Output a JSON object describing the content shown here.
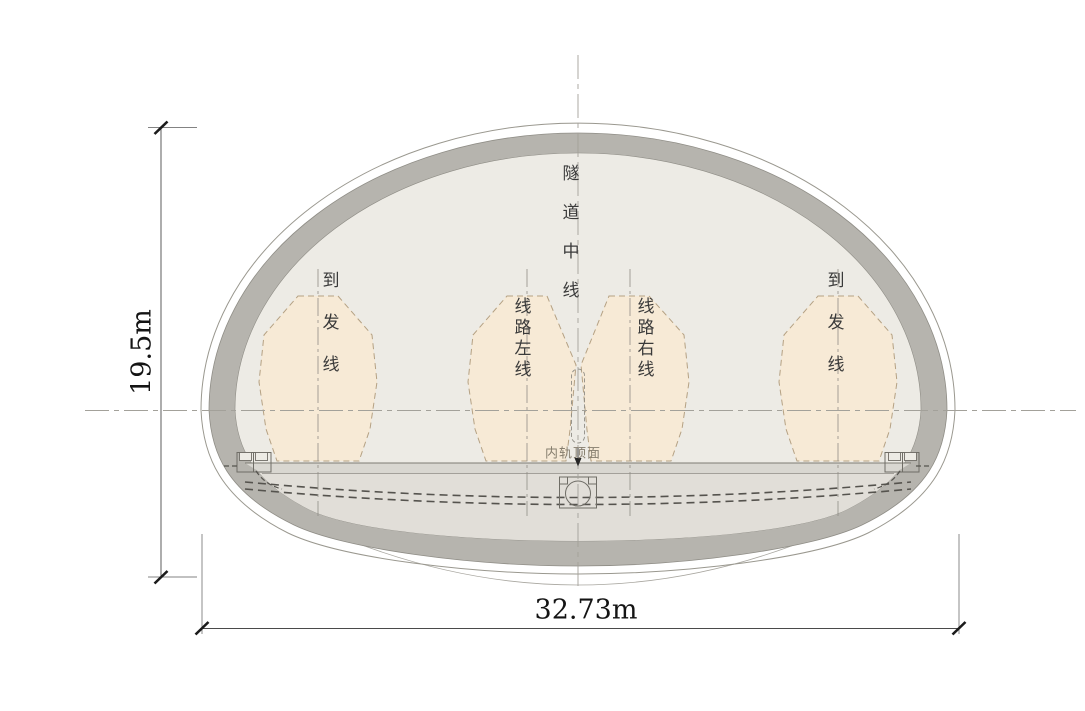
{
  "drawing": {
    "dimensions": {
      "height_label": "19.5m",
      "width_label": "32.73m"
    },
    "labels": {
      "tunnel_centerline": "隧道中线",
      "left_siding": "到发线",
      "route_left": "线路左线",
      "route_right": "线路右线",
      "right_siding": "到发线",
      "inner_rail_top": "内轨顶面"
    },
    "colors": {
      "lining": "#b6b4ae",
      "void-fill": "#edebe5",
      "invert-fill": "#e1ded8",
      "gauge-fill": "#f7ead6",
      "gauge-stroke": "#b5a183",
      "outline": "#8f8d86",
      "centerline": "#a3a19a",
      "dim": "#262626",
      "pipe": "#55534e",
      "label-ink": "#3a3a3a",
      "rail-label-ink": "#867e6e"
    }
  }
}
